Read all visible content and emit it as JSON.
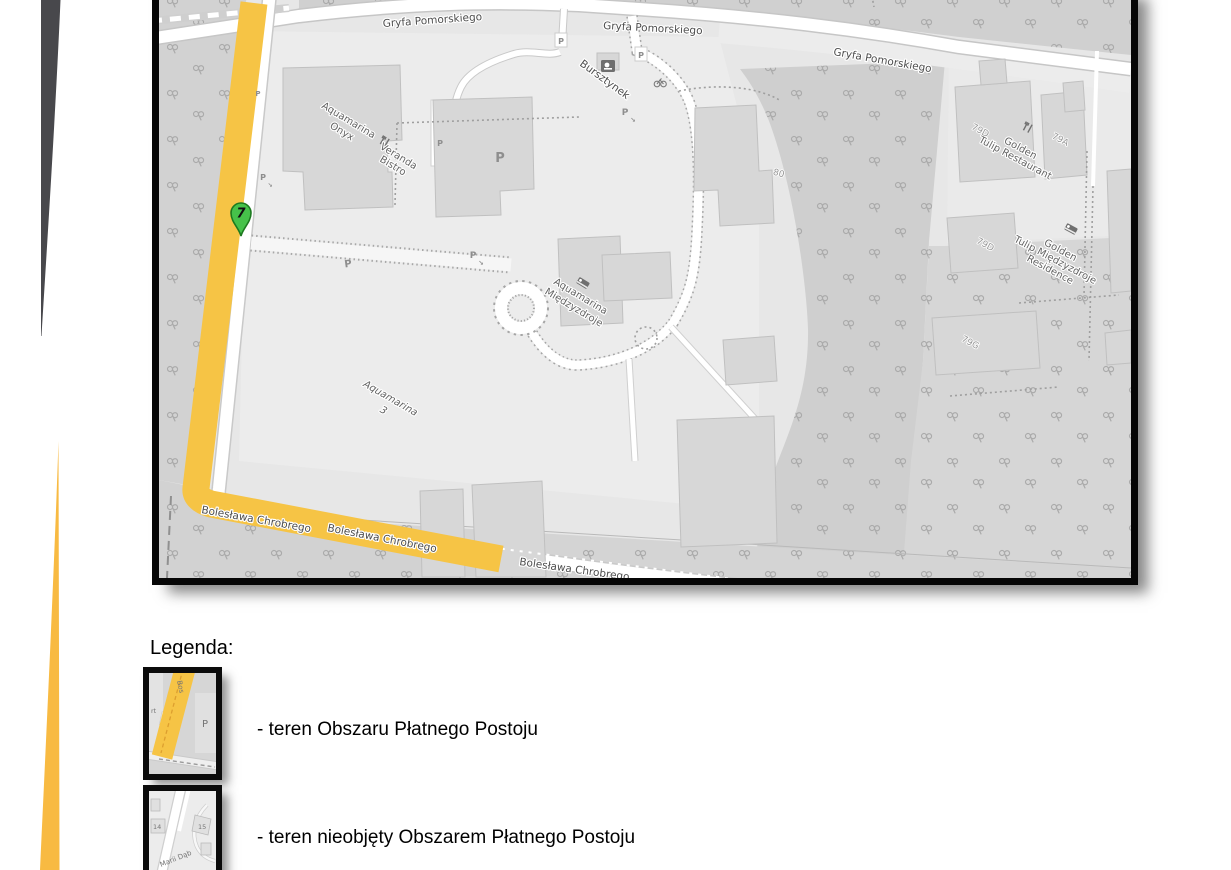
{
  "map": {
    "marker_number": "7",
    "parking_letter": "P",
    "streets": {
      "gryfa_1": "Gryfa Pomorskiego",
      "gryfa_2": "Gryfa Pomorskiego",
      "gryfa_3": "Gryfa Pomorskiego",
      "bursztynek": "Bursztynek",
      "boleslawa_1": "Bolesława Chrobrego",
      "boleslawa_2": "Bolesława Chrobrego",
      "boleslawa_3": "Bolesława Chrobrego"
    },
    "places": {
      "onyx_1": "Aquamarina",
      "onyx_2": "Onyx",
      "veranda_1": "Veranda",
      "veranda_2": "Bistro",
      "aqm_1": "Aquamarina",
      "aqm_2": "Międzyzdroje",
      "aq3_1": "Aquamarina",
      "aq3_2": "3",
      "gtr_1": "Golden",
      "gtr_2": "Tulip Restaurant",
      "gtres_1": "Golden",
      "gtres_2": "Tulip Międzyzdroje",
      "gtres_3": "Residence"
    },
    "buildings": {
      "b80": "80",
      "b79a": "79A",
      "b79d_roof": "79D",
      "b79d": "79D",
      "b79g": "79G"
    },
    "colors": {
      "paid_zone_yellow": "#f6c445",
      "marker_green": "#46c24a",
      "forest_gray": "#d2d2d2",
      "road_white": "#ffffff"
    }
  },
  "legend": {
    "title": "Legenda:",
    "items": [
      {
        "label": "- teren Obszaru Płatnego Postoju"
      },
      {
        "label": "- teren nieobjęty Obszarem Płatnego Postoju"
      }
    ],
    "thumb_paid": {
      "street_label": "Bos",
      "left_fragment": "rt",
      "parking": "P"
    },
    "thumb_unpaid": {
      "b14": "14",
      "b15": "15",
      "street_label": "Marii Dąb"
    }
  }
}
